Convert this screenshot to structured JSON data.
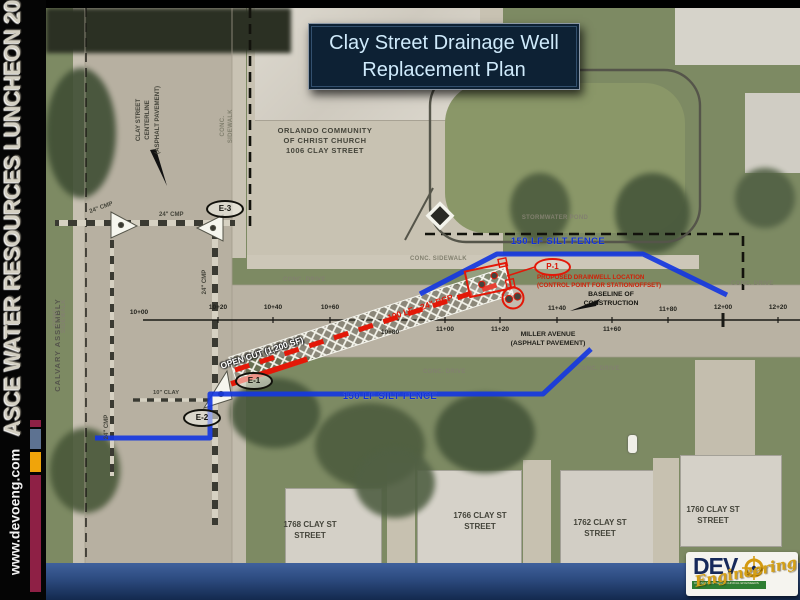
{
  "sidebar": {
    "event": "ASCE WATER RESOURCES LUNCHEON 2010",
    "website": "www.devoeng.com"
  },
  "title": {
    "text": "Clay Street Drainage Well\nReplacement Plan"
  },
  "plan": {
    "church_label": "ORLANDO COMMUNITY\nOF CHRIST CHURCH\n1006 CLAY STREET",
    "pond_label": "STORMWATER POND",
    "silt_fence": "150 LF SILT FENCE",
    "p1": "P-1",
    "drainwell_note": "PROPOSED DRAINWELL LOCATION\n(CONTROL POINT FOR STATION/OFFSET)",
    "baseline_label": "BASELINE OF\nCONSTRUCTION",
    "miller_ave": "MILLER AVENUE\n(ASPHALT PAVEMENT)",
    "clay_centerline": "CLAY STREET CENTERLINE\n(ASPHALT PAVEMENT)",
    "open_cut": "OPEN CUT (1,200 SF)",
    "rcp": "100 LF - 24\" RCP",
    "e1": "E-1",
    "e2": "E-2",
    "e3": "E-3",
    "cmp": "24\" CMP",
    "clay_pipe": "10\" CLAY",
    "calvary": "CALVARY ASSEMBLY",
    "conc_sidewalk": "CONC. SIDEWALK",
    "conc_drive": "CONC. DRIVE",
    "stations": [
      "10+00",
      "10+20",
      "10+40",
      "10+60",
      "10+80",
      "11+00",
      "11+20",
      "11+40",
      "11+60",
      "11+80",
      "12+00",
      "12+20"
    ],
    "addresses": [
      "1768 CLAY ST\nSTREET",
      "1766 CLAY ST\nSTREET",
      "1762 CLAY ST\nSTREET",
      "1760 CLAY ST\nSTREET"
    ]
  },
  "logo": {
    "name": "DEV",
    "script": "Engineering",
    "tagline": "CONSULTING GEOTECHNICAL ENGINEERS"
  },
  "colors": {
    "silt_fence_blue": "#1232d6",
    "proposed_red": "#e31808",
    "title_bg": "#0d2134",
    "title_text": "#cfeafb",
    "accent_maroon": "#8e2045",
    "accent_gold": "#f0a40a",
    "accent_slate": "#5d7291",
    "logo_navy": "#16295a",
    "logo_green": "#2e7d32"
  }
}
